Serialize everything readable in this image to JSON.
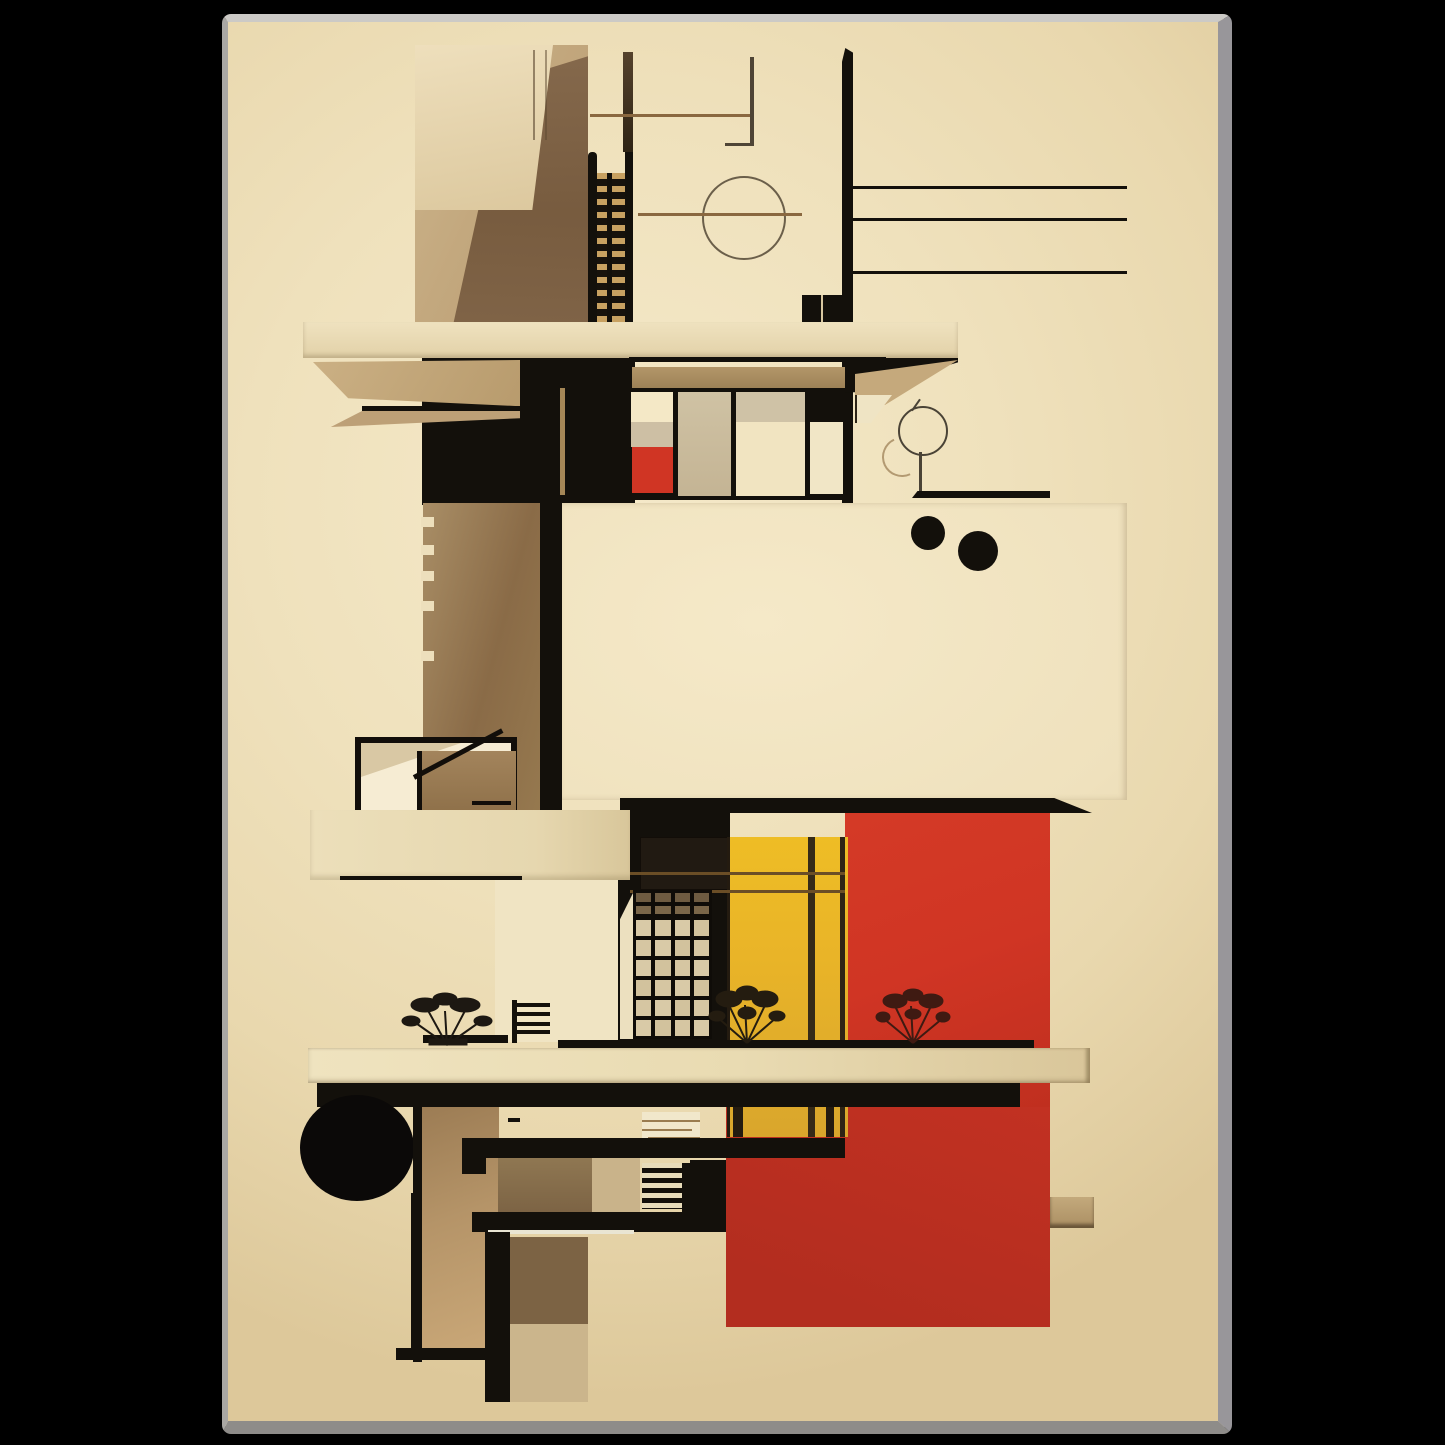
{
  "artwork": {
    "title_visible_text": "",
    "type": "abstract-architectural-art-print",
    "style": "bauhaus-constructivist",
    "scene": {
      "background": "black page behind a tall framed beige poster",
      "elements": [
        "tan tower with dark shaded face and stair ladder column",
        "thin ruled lines, crossing lines and outlined circle top right",
        "three long horizontal rules on right",
        "cantilevered beige shelf with black beam and window strip with small red pane",
        "large cream block with two black dots",
        "white outlined stair box on left",
        "middle dark zone with gridded window, golden yellow panel and large red block",
        "three small plant silhouettes on a long light shelf",
        "solid black circle lower left",
        "black table-like structure with striped ladder block at bottom",
        "small tan ledge on right edge of red block"
      ]
    },
    "palette": {
      "outside": "#000000",
      "bg-light": "#f5e9c9",
      "bg-mid": "#e9d8ae",
      "bg-dark": "#ddc89a",
      "ink": "#13100b",
      "red": "#d03524",
      "red-deep": "#c23122",
      "yellow": "#e9b428",
      "yellow-deep": "#d9a62c",
      "tan": "#c2a678",
      "tan-dark": "#a98a5e",
      "brown": "#8a6b47",
      "brown-dark": "#6e5236",
      "cream": "#f3e6c3",
      "pane": "#cdbfa2",
      "edge-left": "#a9a7a3",
      "edge-right": "#98969a",
      "edge-top": "#cccac6",
      "edge-bottom": "#8e8c89",
      "line-brown": "#8a6840",
      "outline": "#6b5f4a"
    }
  }
}
